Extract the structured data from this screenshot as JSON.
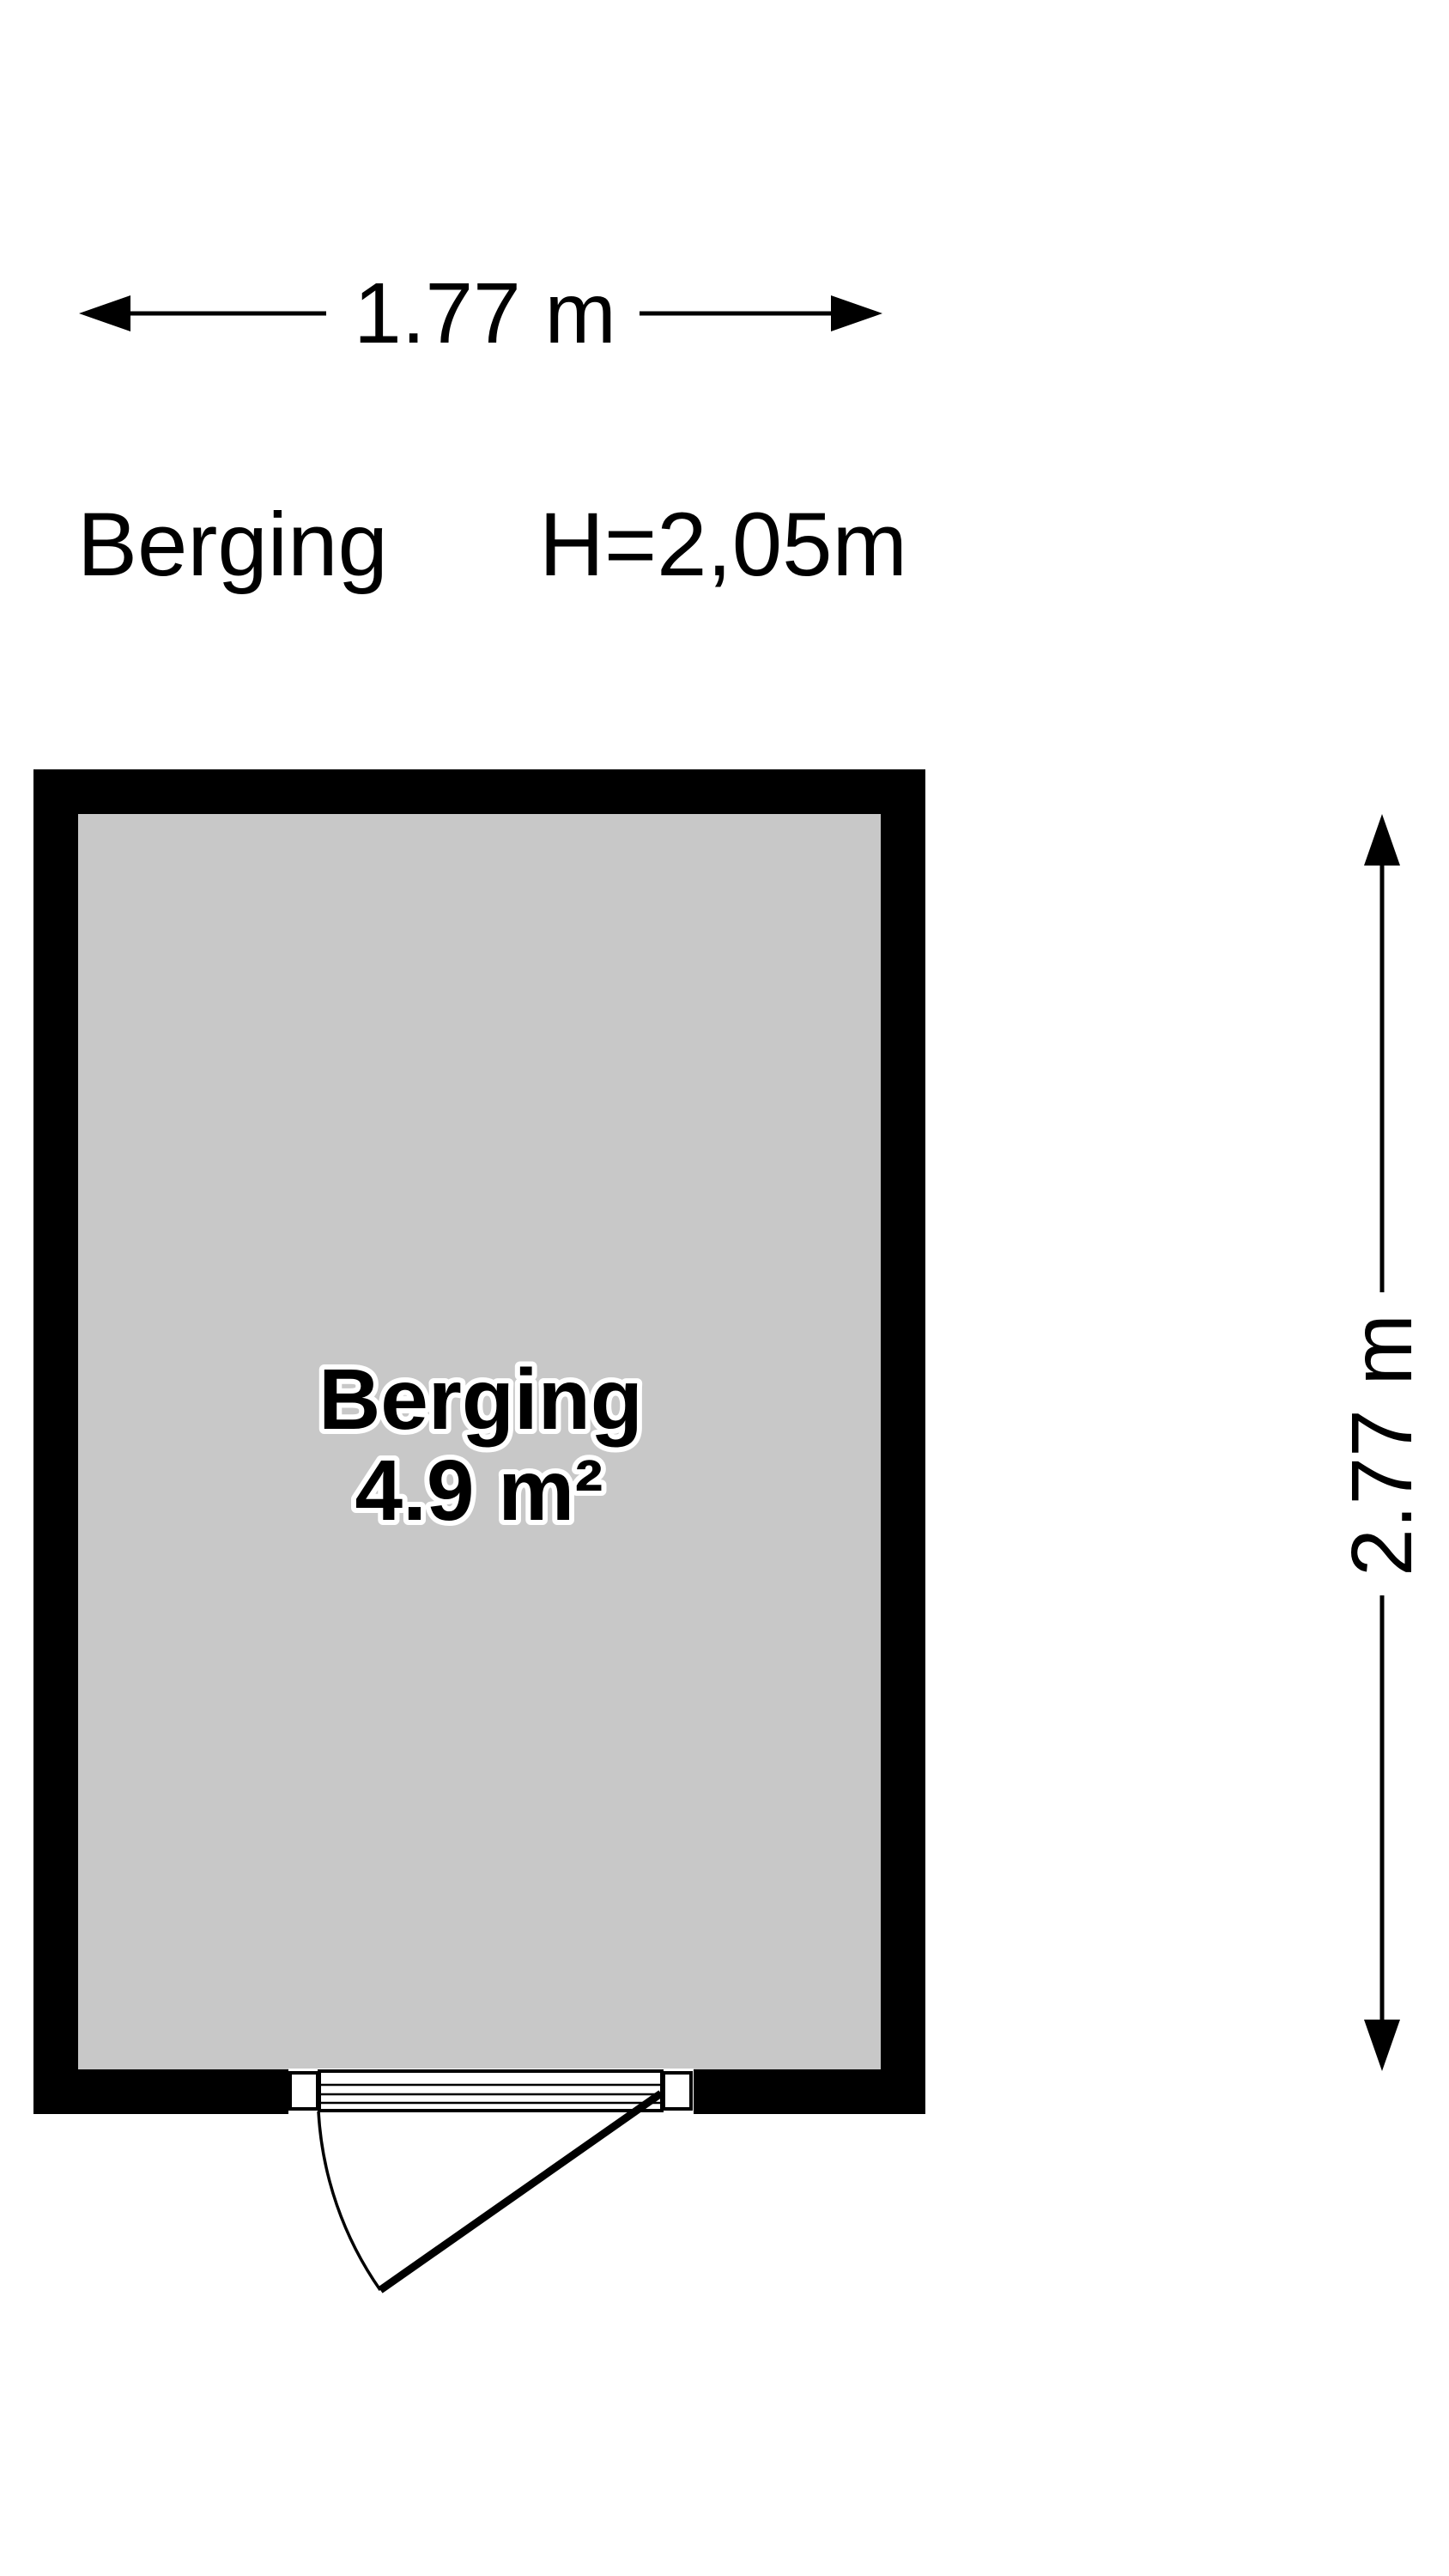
{
  "plan": {
    "title": "Berging",
    "ceiling_height_label": "H=2,05m",
    "room": {
      "name": "Berging",
      "area_label": "4.9 m²",
      "width_label": "1.77 m",
      "depth_label": "2.77 m"
    },
    "colors": {
      "wall": "#000000",
      "floor": "#c8c8c8",
      "background": "#ffffff",
      "line": "#000000"
    }
  }
}
